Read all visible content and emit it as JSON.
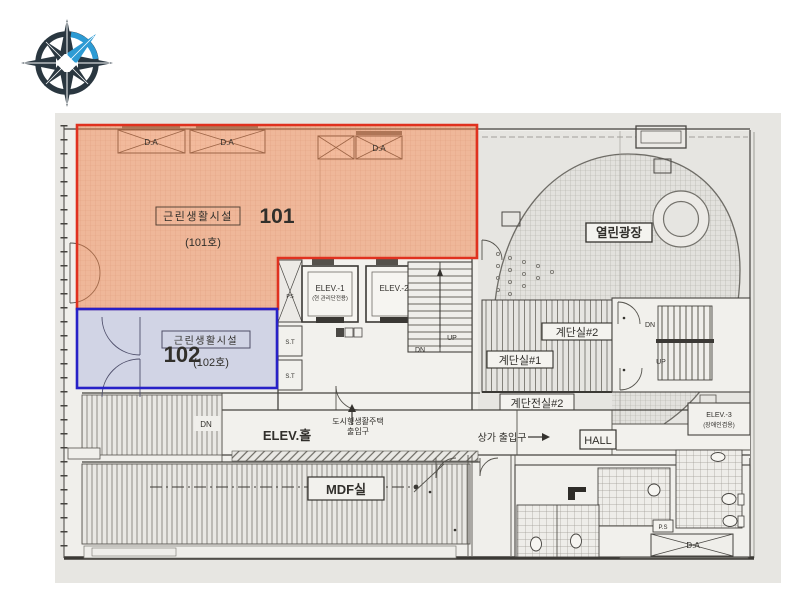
{
  "title": "1F floor plan with highlighted retail units",
  "compass": {
    "blue": "#2d9bd4",
    "dark": "#2a3740"
  },
  "region101": {
    "name": "근린생활시설",
    "unit_no": "(101호)",
    "badge": "101",
    "fill": "#ee7f48",
    "border": "#e0311f",
    "badge_color": "#d6231a"
  },
  "region102": {
    "name": "근린생활시설",
    "unit_no": "(102호)",
    "badge": "102",
    "fill": "#8090d8",
    "border": "#2721c7",
    "badge_color": "#201bc4"
  },
  "labels": {
    "plaza": "열린광장",
    "stair_room_2": "계단실#2",
    "stair_room_1": "계단실#1",
    "stair_vestibule_2": "계단전실#2",
    "elev_1": "ELEV.-1",
    "elev_1_note": "(현 관리단전용)",
    "elev_2": "ELEV.-2",
    "elev_3": "ELEV.-3",
    "elev_3_note": "(장애인겸용)",
    "elev_hall": "ELEV.홀",
    "housing_entrance_1": "도시형생활주택",
    "housing_entrance_2": "출입구",
    "shop_entrance": "상가 출입구",
    "hall": "HALL",
    "mdf_room": "MDF실",
    "dry_area": "D.A",
    "down": "DN",
    "up": "UP",
    "pipe_shaft": "PS",
    "pipe_shaft_dotted": "P.S",
    "shaft_st": "S.T"
  }
}
